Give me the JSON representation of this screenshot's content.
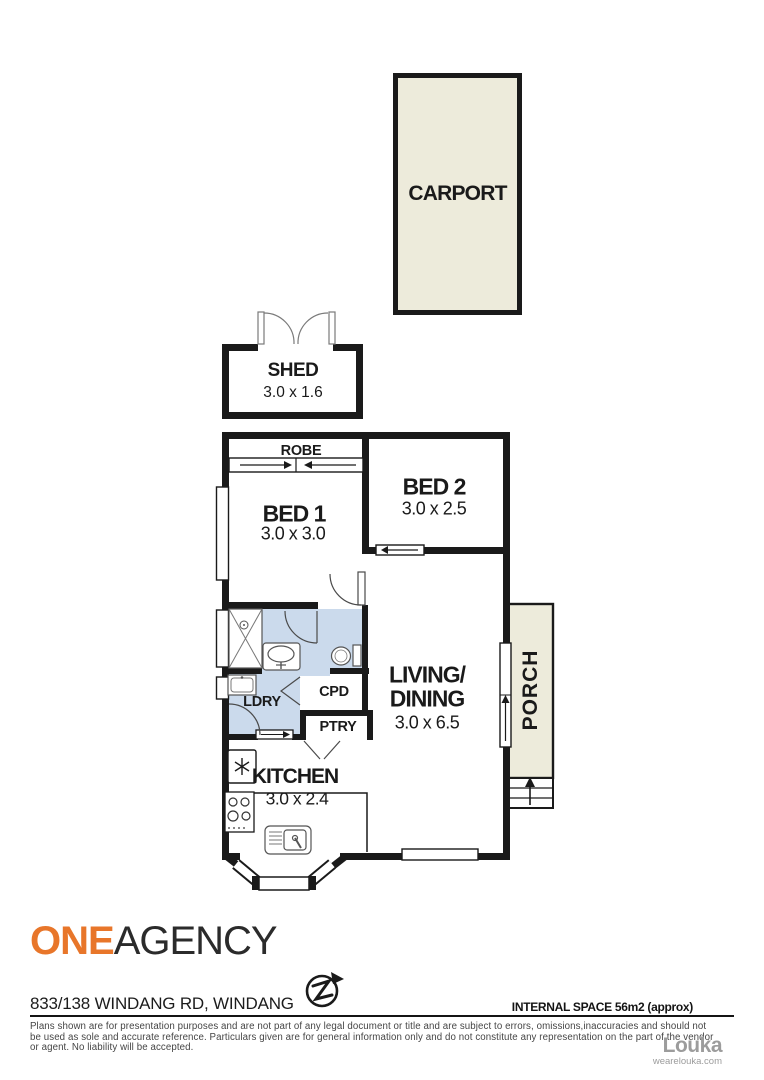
{
  "page": {
    "background": "#ffffff"
  },
  "colors": {
    "wall": "#1a1a1a",
    "cream_fill": "#EDEBDB",
    "wet_area_blue": "#CBDAEC",
    "accent_orange": "#E8762A",
    "logo_gray": "#9c9c9c"
  },
  "plan": {
    "carport": {
      "label": "CARPORT"
    },
    "shed": {
      "label": "SHED",
      "dims": "3.0 x 1.6"
    },
    "robe": {
      "label": "ROBE"
    },
    "bed1": {
      "label": "BED 1",
      "dims": "3.0 x 3.0"
    },
    "bed2": {
      "label": "BED 2",
      "dims": "3.0 x 2.5"
    },
    "living": {
      "label_line1": "LIVING/",
      "label_line2": "DINING",
      "dims": "3.0 x 6.5"
    },
    "kitchen": {
      "label": "KITCHEN",
      "dims": "3.0 x 2.4"
    },
    "laundry": {
      "label": "LDRY"
    },
    "cupboard": {
      "label": "CPD"
    },
    "pantry": {
      "label": "PTRY"
    },
    "porch": {
      "label": "PORCH"
    }
  },
  "footer": {
    "brand": {
      "part1": "ONE",
      "part2": "AGENCY"
    },
    "address": "833/138 WINDANG RD, WINDANG",
    "internal_space": "INTERNAL SPACE  56m2 (approx)",
    "disclaimer_line1": "Plans shown are for presentation purposes and are not part of any legal document or title and are subject to errors, omissions,inaccuracies and should not",
    "disclaimer_line2": "be used as sole and accurate reference. Particulars given are for general information only and do not constitute any representation on the part of the vendor",
    "disclaimer_line3": "or agent. No liability will be accepted.",
    "credit": {
      "name": "Louka",
      "site": "wearelouka.com"
    }
  }
}
